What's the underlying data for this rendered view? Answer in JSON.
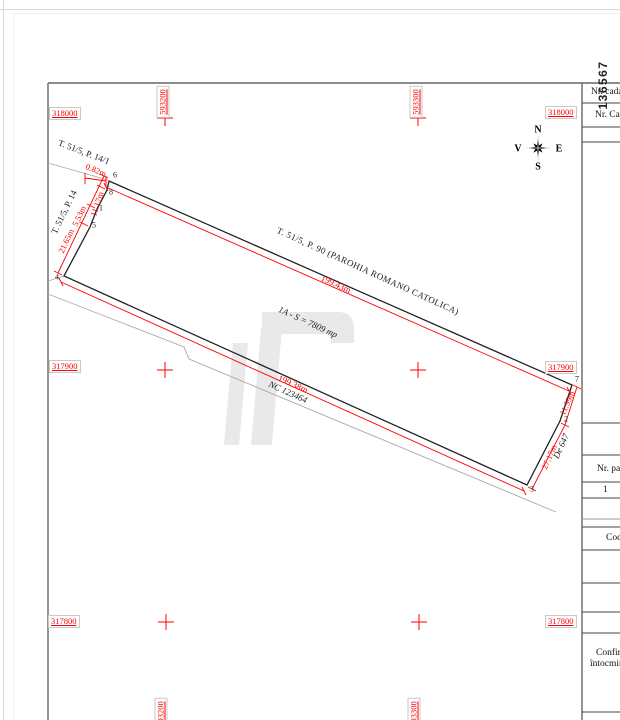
{
  "grid": {
    "northings": [
      "318000",
      "317900",
      "317800"
    ],
    "eastings": [
      "593200",
      "593300"
    ]
  },
  "stamp": {
    "plan_number": "136567"
  },
  "compass": {
    "north": "N",
    "south": "S",
    "east": "E",
    "west": "V"
  },
  "parcel": {
    "label": "T. 51/5, P. 90 (PAROHIA ROMANO  CATOLICA)",
    "area": "1A - S = 7809 mp",
    "neighbor_nc": "NC 123464",
    "road": "De 647",
    "adjacent_top": "T. 51/5, P. 14/1",
    "adjacent_left": "T. 51/5, P. 14",
    "points": {
      "p1": "1",
      "p2": "2",
      "p3": "3",
      "p4": "4",
      "p5": "5",
      "p6": "6",
      "p7": "7",
      "p8": "8"
    },
    "dimensions": {
      "top": "199.43m",
      "bottom": "199.38m",
      "right_upper": "11.99m",
      "right_lower": "27.17m",
      "left_top": "0.82m",
      "left_upper": "11.17m",
      "left_mid": "5.53m",
      "left_lower": "21.65m"
    }
  },
  "info_panel": {
    "row_cadastral": "Nr. cadas",
    "row_carte": "Nr. Carte",
    "row_parcela": "Nr. par",
    "row_parcela_value": "1",
    "row_cod": "Cod",
    "row_confirm_line1": "Confir",
    "row_confirm_line2": "întocmir"
  },
  "colors": {
    "dimension_red": "#ff0000",
    "line_black": "#222222",
    "neighbor_gray": "#aaaaaa",
    "frame_gray": "#666666",
    "watermark_gray": "#e9e9e9"
  }
}
